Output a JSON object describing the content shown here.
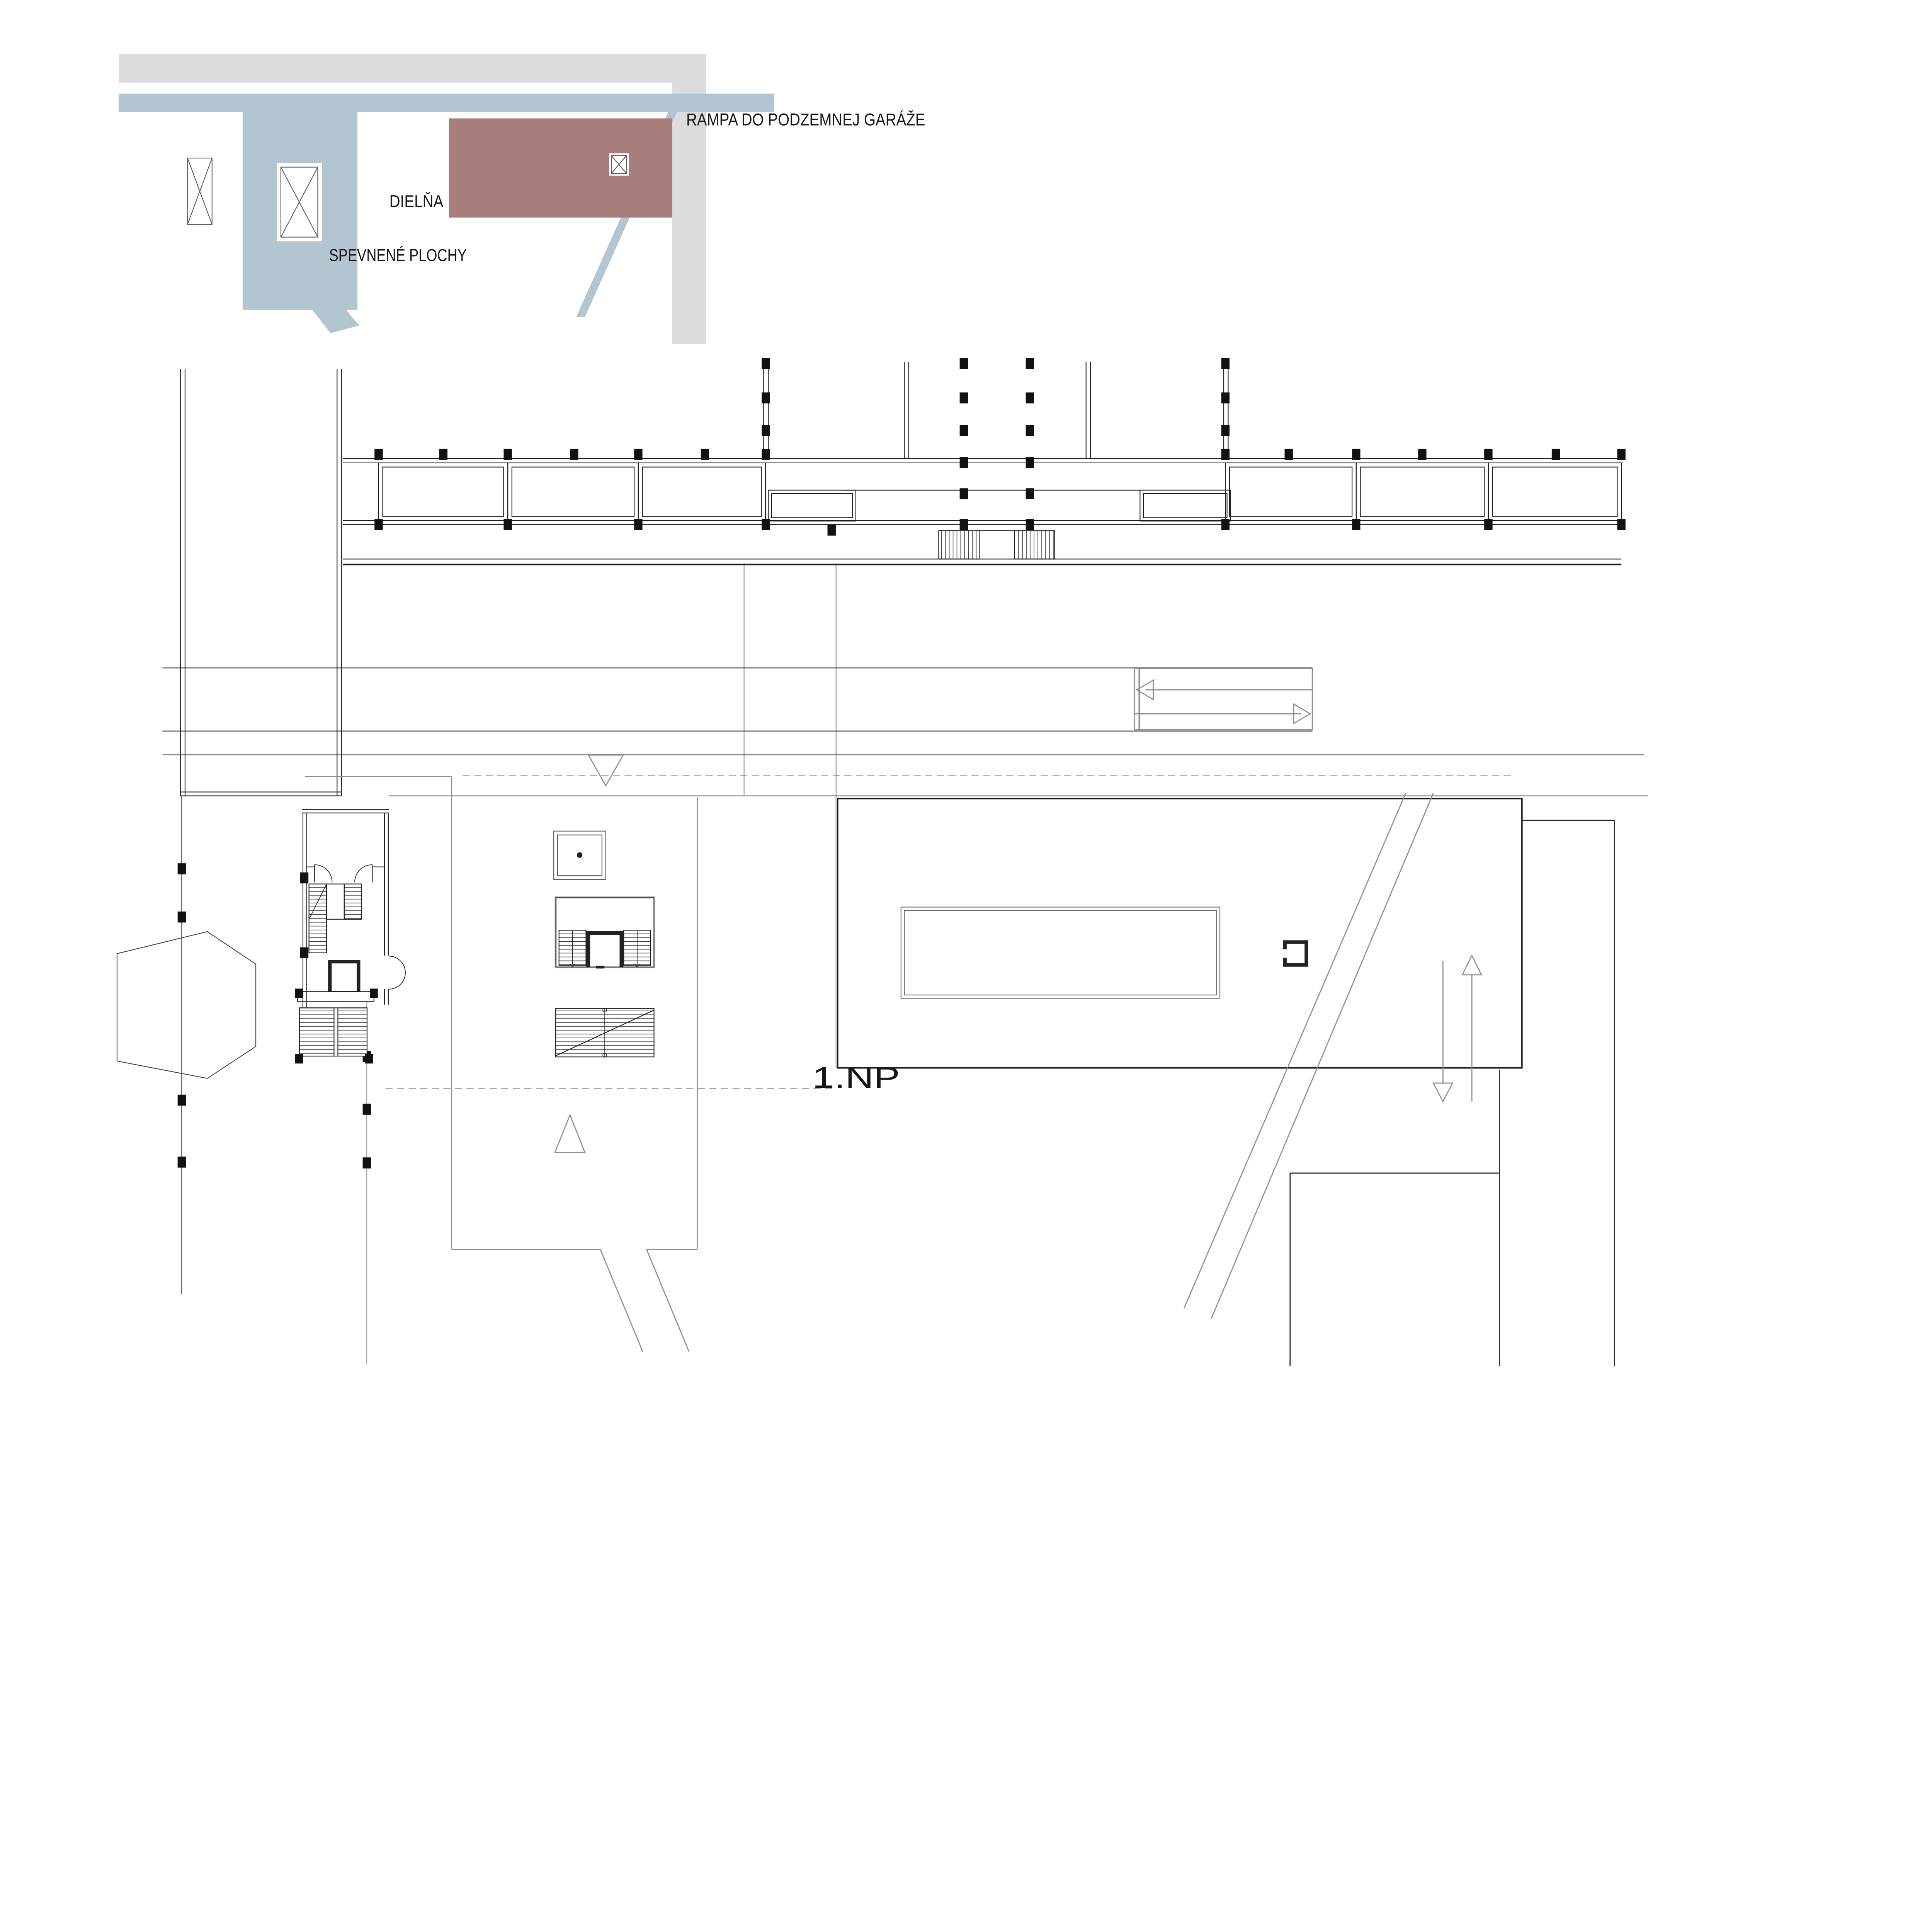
{
  "drawing": {
    "kind": "architectural-site-floor-plan",
    "floor_label": "1.NP",
    "labels": {
      "ramp": "RAMPA DO PODZEMNEJ GARÁŽE",
      "workshop": "DIELŇA",
      "paved_areas": "SPEVNENÉ PLOCHY"
    },
    "colors": {
      "ramp_gray": "#dcdcdc",
      "paved_blue": "#b3c5d1",
      "workshop_red": "#a67e7b",
      "line_black": "#1c1c1c",
      "line_gray": "#8f8f8f",
      "wall_dark": "#222222"
    },
    "symbols": [
      {
        "name": "window-x-symbol",
        "count": 3
      },
      {
        "name": "section-triangle-down",
        "count": 1
      },
      {
        "name": "section-triangle-up",
        "count": 1
      },
      {
        "name": "ramp-direction-arrows",
        "count": 2
      },
      {
        "name": "vertical-circulation-arrows",
        "count": 2
      },
      {
        "name": "stair-core",
        "count": 3
      },
      {
        "name": "elevator-shaft",
        "count": 3
      }
    ]
  }
}
